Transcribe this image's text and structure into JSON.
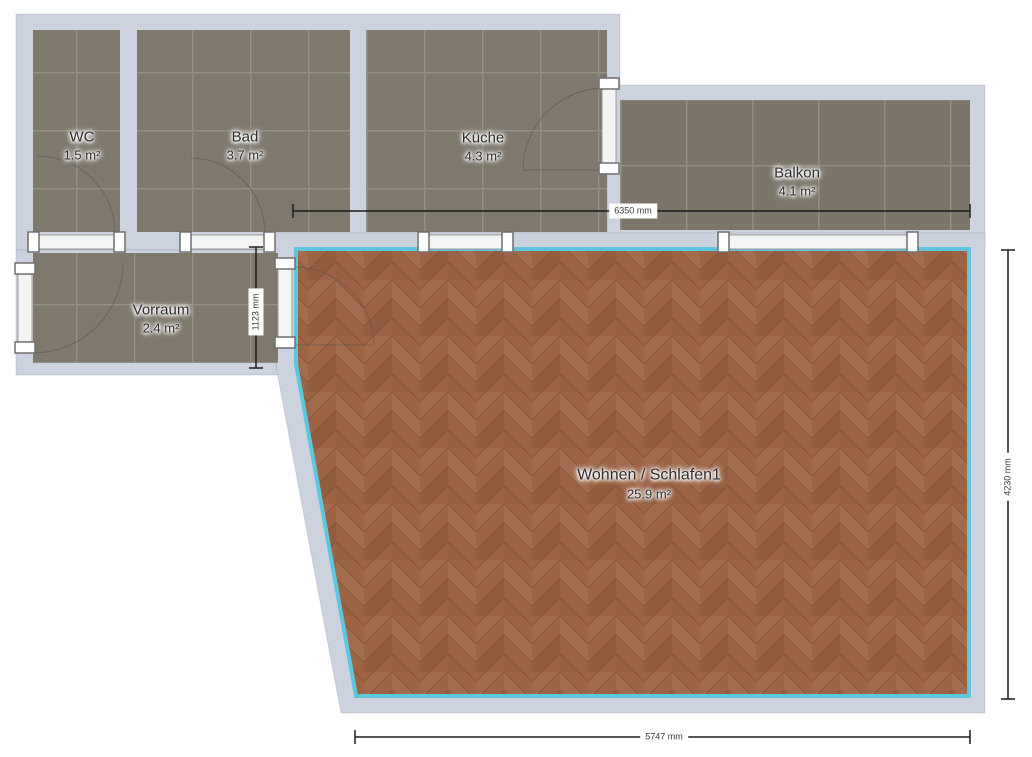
{
  "rooms": [
    {
      "id": "wc",
      "name": "WC",
      "area": "1.5 m²"
    },
    {
      "id": "bad",
      "name": "Bad",
      "area": "3.7 m²"
    },
    {
      "id": "kueche",
      "name": "Küche",
      "area": "4.3 m²"
    },
    {
      "id": "balkon",
      "name": "Balkon",
      "area": "4.1 m²"
    },
    {
      "id": "vorraum",
      "name": "Vorraum",
      "area": "2.4 m²"
    },
    {
      "id": "wohnen",
      "name": "Wohnen / Schlafen1",
      "area": "25.9 m²"
    }
  ],
  "dimensions": [
    {
      "id": "top-width",
      "label": "6350 mm",
      "orientation": "horizontal"
    },
    {
      "id": "vorraum-depth",
      "label": "1123 mm",
      "orientation": "vertical"
    },
    {
      "id": "right-height",
      "label": "4230 mm",
      "orientation": "vertical"
    },
    {
      "id": "bottom-width",
      "label": "5747 mm",
      "orientation": "horizontal"
    }
  ],
  "colors": {
    "wall": "#cdd3de",
    "tile": "#7b756a",
    "parquet": "#9c6444",
    "accent": "#5ec7dd",
    "dimension_line": "#1c1c1c"
  }
}
